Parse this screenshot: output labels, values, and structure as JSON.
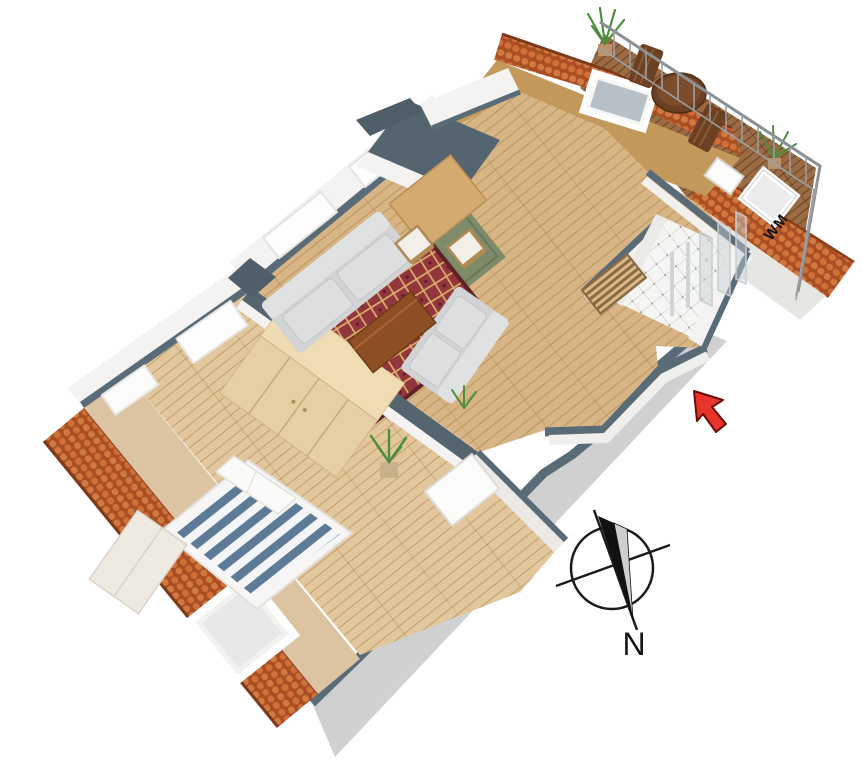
{
  "scene": {
    "type": "3d-floorplan-isometric",
    "background": "#ffffff"
  },
  "labels": {
    "washing_machine": "WM",
    "compass_north": "N"
  },
  "icons": {
    "compass": "compass-rose-icon",
    "entrance_marker": "entrance-arrow-icon"
  },
  "colors": {
    "background": "#ffffff",
    "roof_tile": "#b5582a",
    "roof_tile_light": "#d07a42",
    "roof_ridge": "#7c3a1a",
    "wall_top": "#5a6b78",
    "wall_face": "#f4f3f1",
    "window_glass": "#fdfdfd",
    "skirt_gray": "#cfcfcf",
    "floor_wood": "#d8b585",
    "bedroom_wood": "#e3c79c",
    "slope_tan": "#dcc3a2",
    "slope_mustard": "#c2995b",
    "slope_bath": "#e8e6e2",
    "deck_wood": "#9b6b44",
    "bed_stripe": "#5d7a96",
    "bed_white": "#f4f5f6",
    "sofa_gray": "#d2d3d4",
    "sofa_light": "#e0e1e2",
    "rug_red": "#93353c",
    "rug_gold": "#d9b36a",
    "rug_green": "#7e8b68",
    "dining_table": "#d3aa70",
    "coffee_table": "#8f4f24",
    "balcony_furniture": "#6b4023",
    "wardrobe_top": "#f0dcb2",
    "wardrobe_front": "#e6cfa2",
    "plant_green": "#4e8c3f",
    "bath_tile": "#f4f4f2",
    "glass": "#c7d0d5",
    "railing": "#8a9094",
    "compass_ink": "#1c1c1c",
    "compass_needle_light": "#cfcfcf",
    "arrow_red": "#e8352b",
    "arrow_outline": "#6b0d08"
  }
}
